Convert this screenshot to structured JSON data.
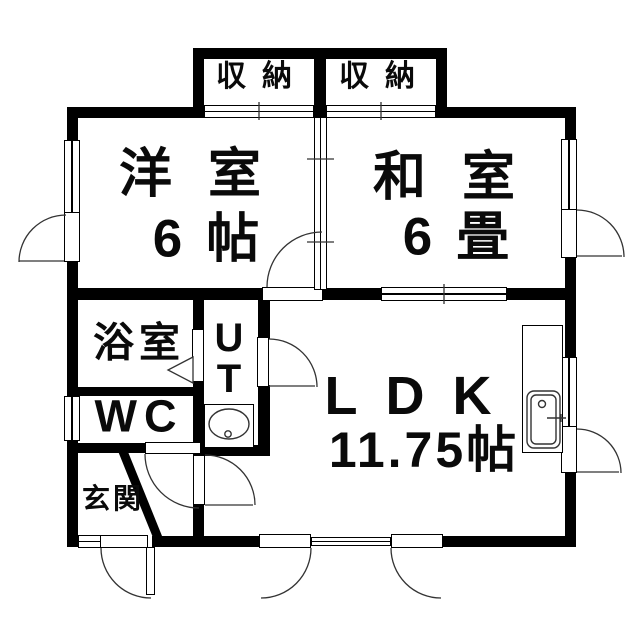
{
  "rooms": {
    "closet_left": {
      "label": "収納"
    },
    "closet_right": {
      "label": "収納"
    },
    "western_room": {
      "name": "洋室",
      "size": "6帖"
    },
    "japanese_room": {
      "name": "和室",
      "size": "6畳"
    },
    "bathroom": {
      "label": "浴室"
    },
    "utility": {
      "line1": "U",
      "line2": "T"
    },
    "wc": {
      "label": "WC"
    },
    "entrance": {
      "label": "玄関"
    },
    "ldk": {
      "name": "LDK",
      "size": "11.75帖"
    }
  },
  "colors": {
    "wall": "#000000",
    "background": "#ffffff",
    "symbol_line": "#333333"
  }
}
